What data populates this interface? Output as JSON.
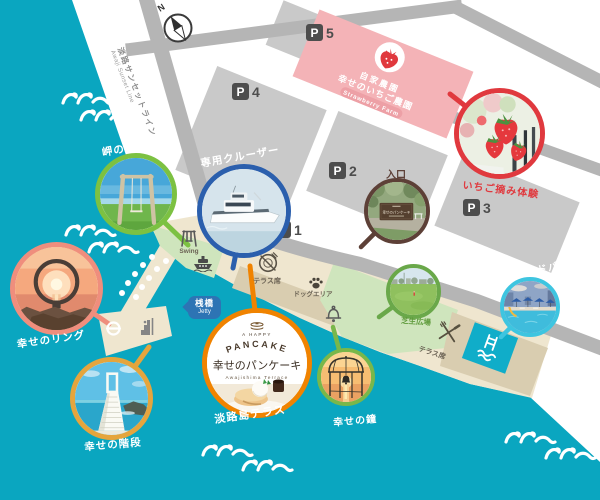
{
  "compass": {
    "label": "N"
  },
  "road": {
    "name_jp": "淡路サンセットライン",
    "name_en": "Awaji Sunset Line"
  },
  "parking": {
    "symbol": "P",
    "p1": "1",
    "p2": "2",
    "p3": "3",
    "p4": "4",
    "p5": "5"
  },
  "farm": {
    "line1": "自家農園",
    "line2": "幸せのいちご農園",
    "line3": "Strawberry Farm"
  },
  "entrance": {
    "label": "入口",
    "sign_text": "幸せのパンケーキ"
  },
  "jetty": {
    "label_jp": "桟橋",
    "label_en": "Jetty"
  },
  "facilities": {
    "swing_en": "Swing",
    "terrace_seats_1": "テラス席",
    "dog_area": "ドッグエリア",
    "terrace_seats_2": "テラス席"
  },
  "spots": {
    "swing": {
      "label": "岬のブランコ",
      "accent": "#7cc142"
    },
    "cruiser": {
      "label": "専用クルーザー",
      "accent": "#2b5fad"
    },
    "strawberry": {
      "label": "いちご摘み体験",
      "accent": "#e0393e"
    },
    "ring": {
      "label": "幸せのリング",
      "accent": "#ef8e7d"
    },
    "stairs": {
      "label": "幸せの階段",
      "accent": "#e5a53d"
    },
    "terrace": {
      "label": "淡路島テラス",
      "accent": "#f08300"
    },
    "bell": {
      "label": "幸せの鐘",
      "accent": "#79b74a"
    },
    "lawn": {
      "label": "芝生広場",
      "accent": "#6aa84a"
    },
    "poolside": {
      "label": "プールサイドバー",
      "accent": "#3ec5e0"
    }
  },
  "logo": {
    "top": "A HAPPY",
    "arc": "PANCAKE",
    "name_jp": "幸せのパンケーキ",
    "name_en": "Awajishima Terrace"
  },
  "colors": {
    "sea": "#0aa6c0",
    "land": "#ffffff",
    "road": "#b5b5b5",
    "parking_lot": "#c9c9c9",
    "promenade": "#efe6cf",
    "building_band": "#d9cdb0",
    "park_green": "#cfe5bd",
    "farm_pink": "#f4b3b7",
    "pool": "#10adc9",
    "jetty_badge": "#2d74b4"
  }
}
